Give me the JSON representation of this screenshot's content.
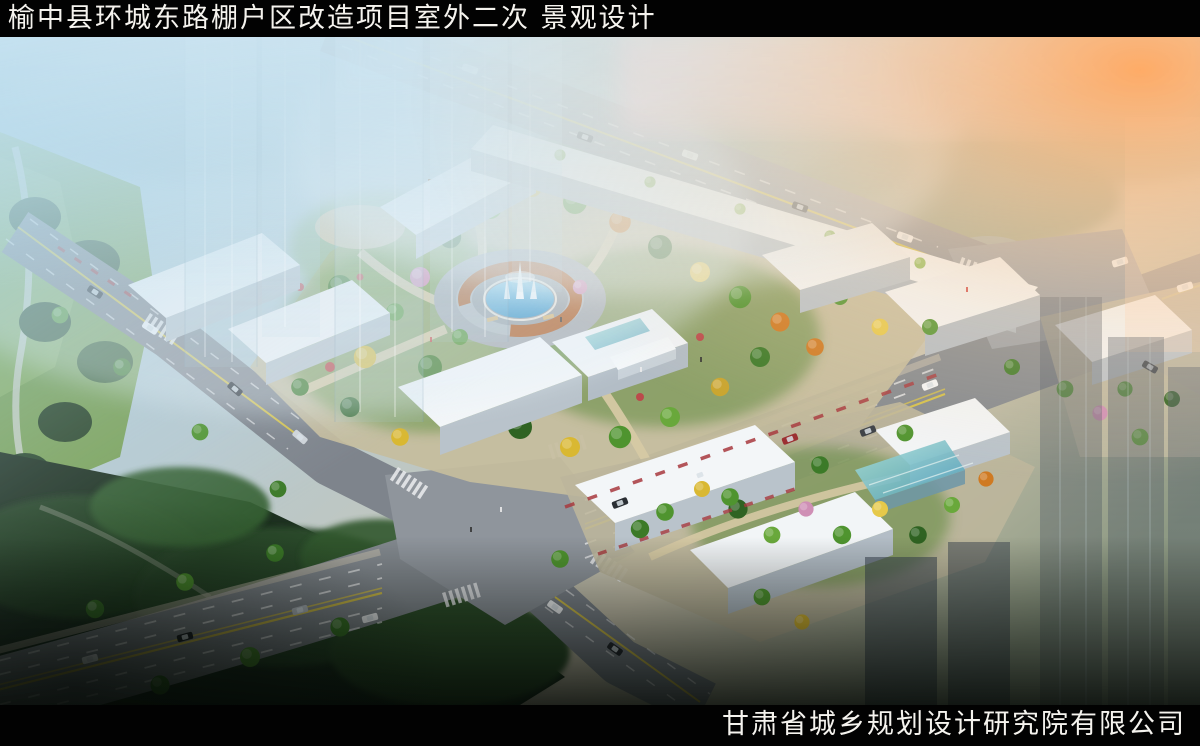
{
  "header": {
    "title": "榆中县环城东路棚户区改造项目室外二次 景观设计"
  },
  "footer": {
    "company": "甘肃省城乡规划设计研究院有限公司"
  },
  "colors": {
    "bar_background": "#020202",
    "bar_text": "#f5f3ee",
    "sky_haze_blue": "#9fd4ee",
    "sunset_glow_orange": "#ffac68",
    "building_white": "#f3f6f8",
    "building_face_gray": "#c2cbd3",
    "road_gray": "#83898f",
    "lane_yellow": "#d4c14a",
    "fountain_water_blue": "#59aedd",
    "pergola_orange": "#b05f28",
    "foliage_green": "#4f942f",
    "foliage_autumn_yellow": "#d9b832",
    "foliage_autumn_orange": "#cf7a22",
    "blossom_pink": "#cf8fb5",
    "park_dark_green": "#1f3822",
    "path_beige": "#d6c9a4"
  },
  "scene_labels": {
    "type": "aerial-architectural-rendering",
    "central_feature": "circular-fountain-plaza",
    "site": "residential-blocks-with-courtyard-garden"
  }
}
